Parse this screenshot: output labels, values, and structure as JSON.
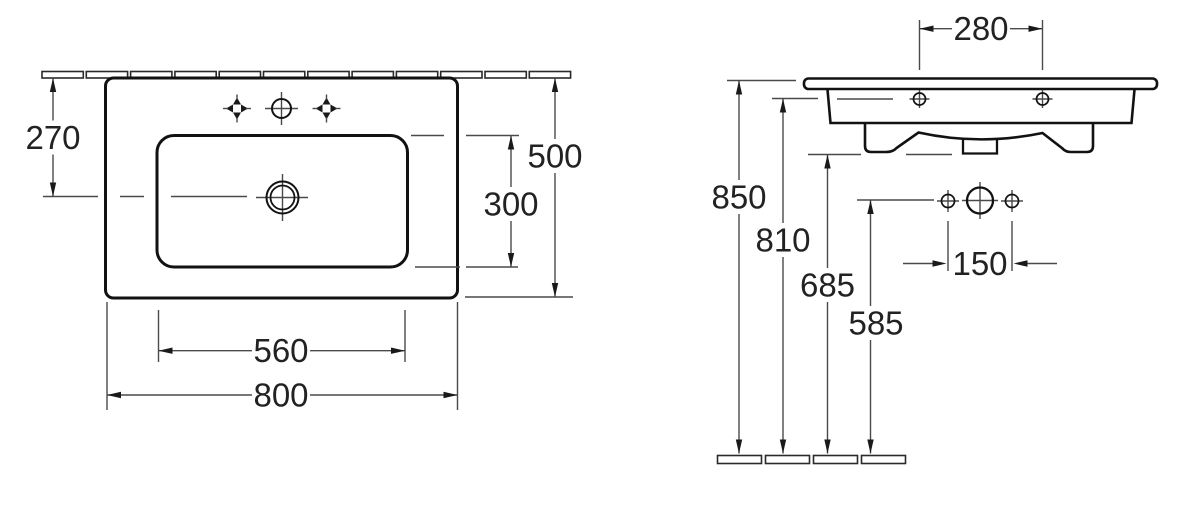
{
  "drawing": {
    "type": "washbasin-dimension-drawing",
    "colors": {
      "background": "#ffffff",
      "outline": "#121212",
      "dimension_lines": "#4a4a4a",
      "text": "#222222"
    },
    "views": {
      "top": {
        "dims": {
          "v270": "270",
          "v500": "500",
          "v300": "300",
          "v560": "560",
          "v800": "800"
        }
      },
      "front": {
        "dims": {
          "v280": "280",
          "v850": "850",
          "v810": "810",
          "v685": "685",
          "v585": "585",
          "v150": "150"
        }
      }
    }
  }
}
